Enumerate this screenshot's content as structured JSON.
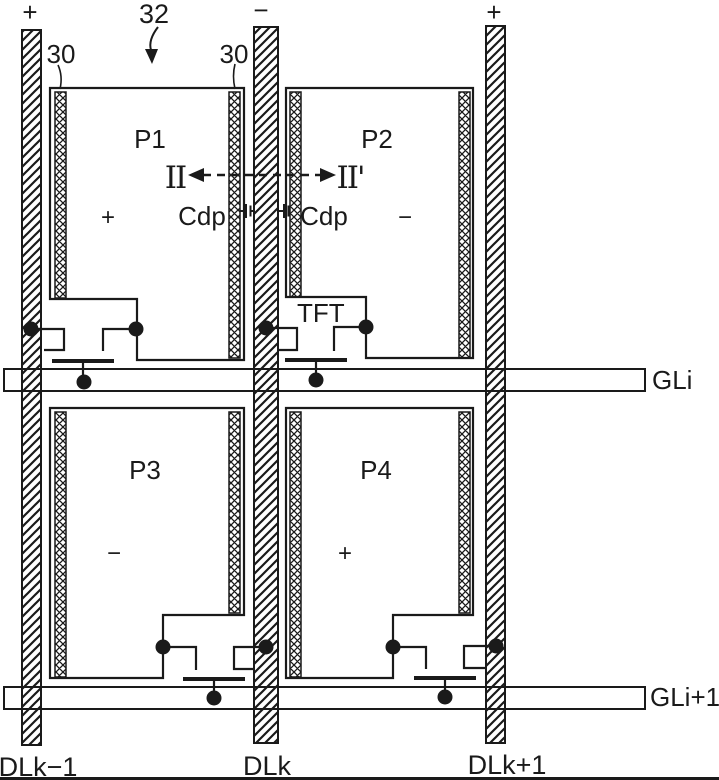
{
  "colors": {
    "ink": "#1a1a1a",
    "paper": "#ffffff"
  },
  "refs": {
    "r32": "32",
    "r30_left": "30",
    "r30_right": "30",
    "tft": "TFT"
  },
  "section": {
    "left": "II",
    "right": "II'"
  },
  "caps": {
    "left": "Cdp",
    "right": "Cdp"
  },
  "data_lines": {
    "prev": {
      "label": "DLk−1",
      "polarity": "+"
    },
    "mid": {
      "label": "DLk",
      "polarity": "−"
    },
    "next": {
      "label": "DLk+1",
      "polarity": "+"
    }
  },
  "gate_lines": {
    "i": {
      "label": "GLi"
    },
    "i1": {
      "label": "GLi+1"
    }
  },
  "pixels": {
    "p1": {
      "label": "P1",
      "polarity": "+"
    },
    "p2": {
      "label": "P2",
      "polarity": "−"
    },
    "p3": {
      "label": "P3",
      "polarity": "−"
    },
    "p4": {
      "label": "P4",
      "polarity": "+"
    }
  }
}
